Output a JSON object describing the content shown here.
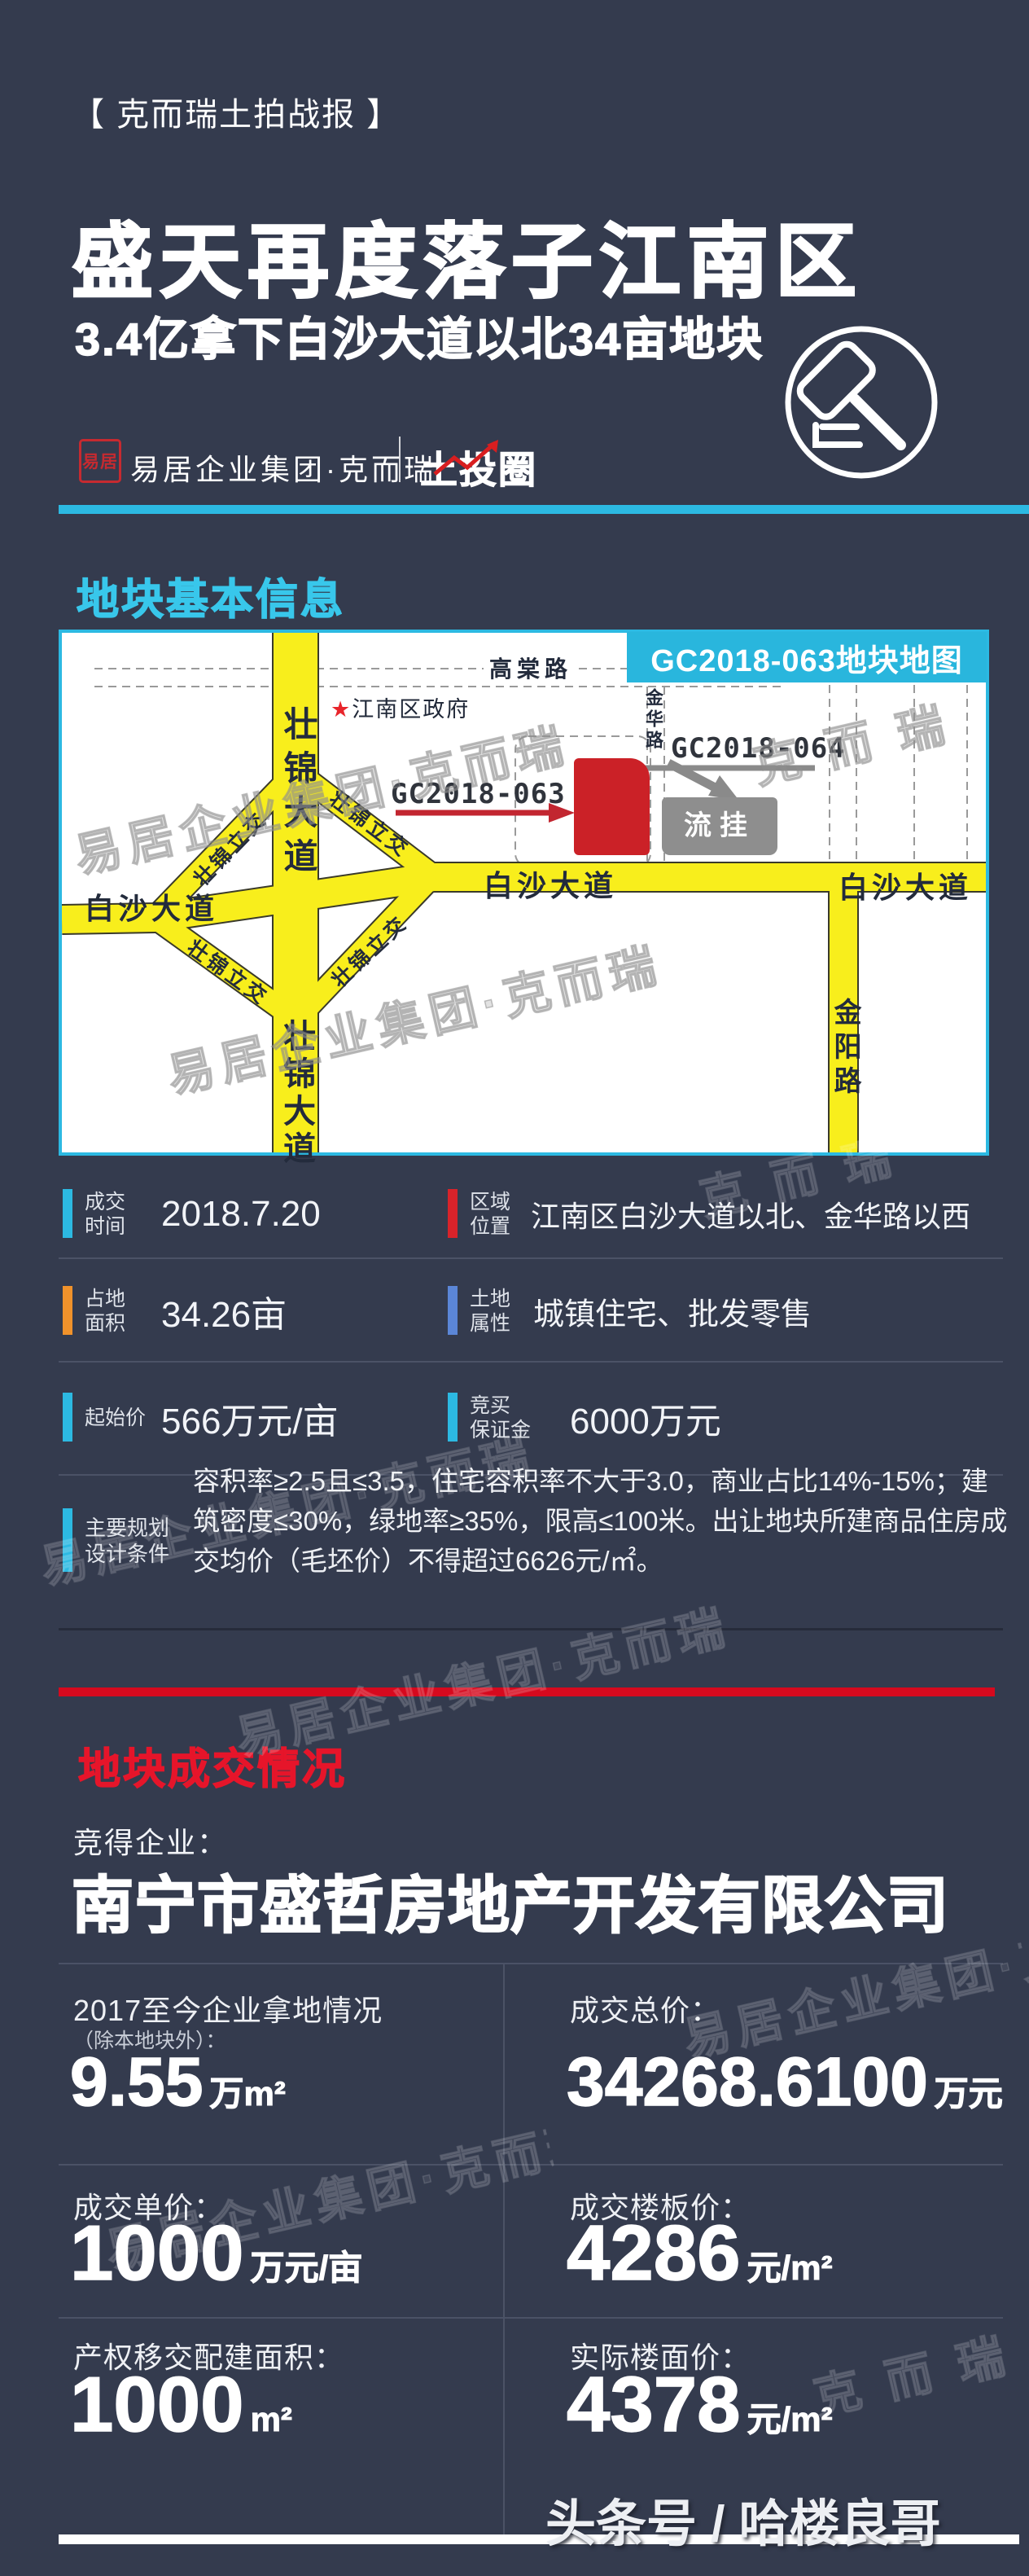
{
  "page": {
    "bg": "#343b4e",
    "accent_cyan": "#2cb9e2",
    "accent_red": "#d6091e"
  },
  "header": {
    "tagline": "【 克而瑞土拍战报 】",
    "title": "盛天再度落子江南区",
    "subtitle": "3.4亿拿下白沙大道以北34亩地块",
    "brand": {
      "seal": "易居",
      "name": "易居企业集团·克而瑞",
      "product": "土投圈"
    },
    "gavel_icon": "auction-gavel-icon"
  },
  "section_info": {
    "title": "地块基本信息",
    "title_color": "#38c7eb",
    "map": {
      "badge": "GC2018-063地块地图",
      "badge_bg": "#29b6dd",
      "road_color": "#f8ee1c",
      "roads": {
        "gaotang": "高棠路",
        "jinhua": "金华路",
        "zhuangjin_top": "壮锦大道",
        "zhuangjin_bottom": "壮锦大道",
        "baisha_left": "白沙大道",
        "baisha_mid": "白沙大道",
        "baisha_right": "白沙大道",
        "jinyang": "金阳路",
        "interchange": "壮锦立交"
      },
      "landmark": {
        "star": "★",
        "name": "江南区政府"
      },
      "parcel_red": {
        "id": "GC2018-063",
        "color": "#cb2127"
      },
      "parcel_gray": {
        "id": "GC2018-064",
        "label": "流挂",
        "color": "#8e8e8e"
      }
    }
  },
  "info_rows": [
    {
      "label": "成交\n时间",
      "value": "2018.7.20",
      "accent": "#2cb9e2"
    },
    {
      "label": "区域\n位置",
      "value": "江南区白沙大道以北、金华路以西",
      "accent": "#d8232a"
    },
    {
      "label": "占地\n面积",
      "value": "34.26亩",
      "accent": "#f0922b"
    },
    {
      "label": "土地\n属性",
      "value": "城镇住宅、批发零售",
      "accent": "#5b86d7"
    },
    {
      "label": "起始价",
      "value": "566万元/亩",
      "accent": "#2cb9e2"
    },
    {
      "label": "竞买\n保证金",
      "value": "6000万元",
      "accent": "#2cb9e2"
    },
    {
      "label": "主要规划\n设计条件",
      "value": "容积率≥2.5且≤3.5，住宅容积率不大于3.0，商业占比14%-15%；建筑密度≤30%，绿地率≥35%，限高≤100米。出让地块所建商品住房成交均价（毛坯价）不得超过6626元/㎡。",
      "accent": "#2cb9e2"
    }
  ],
  "deal": {
    "title": "地块成交情况",
    "title_color": "#e6152a",
    "bar_color": "#d6091e",
    "winner_label": "竞得企业：",
    "winner_name": "南宁市盛哲房地产开发有限公司",
    "stats": [
      {
        "label": "2017至今企业拿地情况",
        "sublabel": "（除本地块外）：",
        "number": "9.55",
        "unit": "万m²"
      },
      {
        "label": "成交总价：",
        "sublabel": "",
        "number": "34268.6100",
        "unit": "万元"
      },
      {
        "label": "成交单价：",
        "sublabel": "",
        "number": "1000",
        "unit": "万元/亩"
      },
      {
        "label": "成交楼板价：",
        "sublabel": "",
        "number": "4286",
        "unit": "元/m²"
      },
      {
        "label": "产权移交配建面积：",
        "sublabel": "",
        "number": "1000",
        "unit": "m²"
      },
      {
        "label": "实际楼面价：",
        "sublabel": "",
        "number": "4378",
        "unit": "元/m²"
      }
    ]
  },
  "watermarks": {
    "brand": "易居企业集团·克而瑞",
    "short": "克 而 瑞",
    "footer": "头条号 / 哈楼良哥"
  }
}
